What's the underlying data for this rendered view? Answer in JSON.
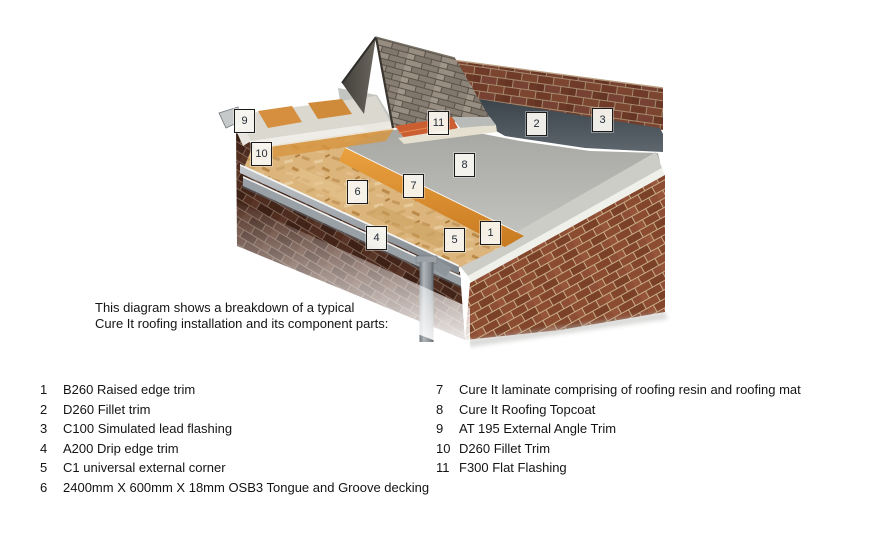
{
  "intro": {
    "line1": "This diagram shows a breakdown of a typical",
    "line2": "Cure It roofing installation and its component parts:"
  },
  "legend": {
    "left": [
      {
        "num": "1",
        "label": "B260 Raised edge trim"
      },
      {
        "num": "2",
        "label": "D260 Fillet trim"
      },
      {
        "num": "3",
        "label": "C100 Simulated lead flashing"
      },
      {
        "num": "4",
        "label": "A200 Drip edge trim"
      },
      {
        "num": "5",
        "label": "C1 universal external corner"
      },
      {
        "num": "6",
        "label": "2400mm X 600mm X 18mm OSB3 Tongue and Groove decking"
      }
    ],
    "right": [
      {
        "num": "7",
        "label": "Cure It laminate comprising of roofing resin and roofing mat"
      },
      {
        "num": "8",
        "label": "Cure It Roofing Topcoat"
      },
      {
        "num": "9",
        "label": "AT 195 External Angle Trim"
      },
      {
        "num": "10",
        "label": "D260 Fillet Trim"
      },
      {
        "num": "11",
        "label": "F300 Flat Flashing"
      }
    ]
  },
  "diagram": {
    "markers": [
      {
        "num": "1",
        "x": 480,
        "y": 221
      },
      {
        "num": "2",
        "x": 526,
        "y": 112
      },
      {
        "num": "3",
        "x": 592,
        "y": 108
      },
      {
        "num": "4",
        "x": 366,
        "y": 226
      },
      {
        "num": "5",
        "x": 444,
        "y": 228
      },
      {
        "num": "6",
        "x": 347,
        "y": 180
      },
      {
        "num": "7",
        "x": 403,
        "y": 174
      },
      {
        "num": "8",
        "x": 454,
        "y": 153
      },
      {
        "num": "9",
        "x": 234,
        "y": 109
      },
      {
        "num": "10",
        "x": 251,
        "y": 142
      },
      {
        "num": "11",
        "x": 428,
        "y": 111
      }
    ],
    "colors": {
      "topcoat": "#b4b4b0",
      "osb_decking": "#d9b279",
      "laminate": "#dd8f2f",
      "lead_flashing": "#4d555d",
      "brick": "#84472e",
      "flat_flashing": "#c95f31",
      "trim": "#8a9197"
    }
  }
}
